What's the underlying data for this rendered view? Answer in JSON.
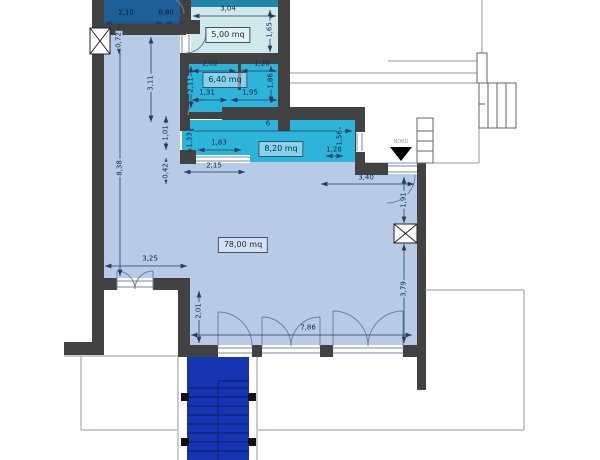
{
  "plan": {
    "type": "architectural floor plan",
    "north_label": "NORD"
  },
  "colors": {
    "wall": "#424242",
    "main_room": "#b7cbe7",
    "pale_room": "#cfe8ec",
    "cyan_room": "#2cb4da",
    "dark_blue_room": "#1f5f98",
    "teal_strip": "#2187a8",
    "stair": "#1535b2",
    "dim_text": "#16244a",
    "outline": "#8f9aa8"
  },
  "rooms": {
    "room_5": {
      "area_label": "5,00 mq"
    },
    "room_6": {
      "area_label": "6,40 mq"
    },
    "room_8": {
      "area_label": "8,20 mq"
    },
    "room_78": {
      "area_label": "78,00 mq"
    }
  },
  "dims": {
    "d210": "2,10",
    "d080": "0,80",
    "d304": "3,04",
    "d165": "1,65",
    "d072": "0,72",
    "d311": "3,11",
    "d202": "2,02",
    "d120": "1,20",
    "d211": "2,11",
    "d186": "1,86",
    "d131": "1,31",
    "d195": "1,95",
    "d838": "8,38",
    "d101": "1,01",
    "d042": "0,42",
    "d133": "1,33",
    "d183": "1,83",
    "d6": "6",
    "d156": "1,56",
    "d128": "1,28",
    "d215": "2,15",
    "d340": "3,40",
    "d191": "1,91",
    "d379": "3,79",
    "d325": "3,25",
    "d201": "2,01",
    "d786": "7,86"
  }
}
